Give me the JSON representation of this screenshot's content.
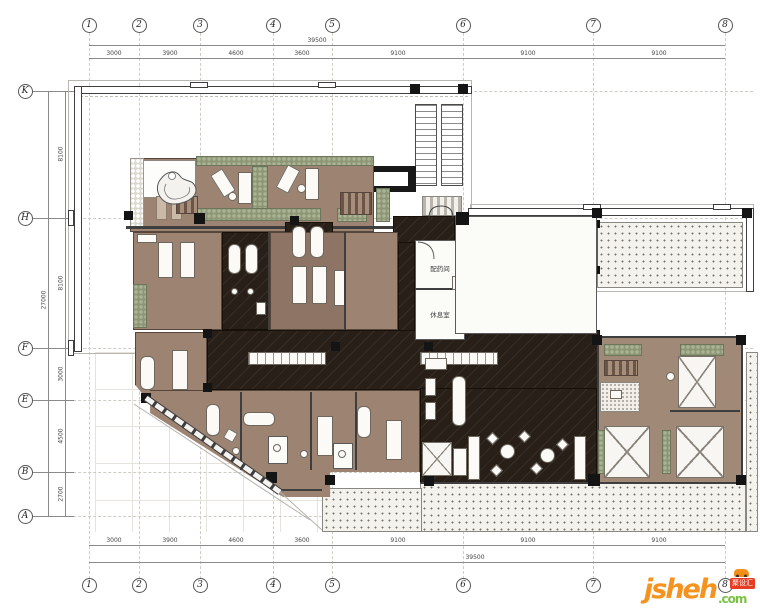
{
  "grid": {
    "top": [
      "1",
      "2",
      "3",
      "4",
      "5",
      "6",
      "7",
      "8"
    ],
    "bottom": [
      "1",
      "2",
      "3",
      "4",
      "5",
      "6",
      "7",
      "8"
    ],
    "left": [
      "K",
      "H",
      "F",
      "E",
      "B",
      "A"
    ]
  },
  "dimensions": {
    "top": {
      "overall": "39500",
      "segments": [
        "3000",
        "3900",
        "4600",
        "3600",
        "9100",
        "9100",
        "9100"
      ]
    },
    "bottom": {
      "overall": "39500",
      "segments": [
        "3000",
        "3900",
        "4600",
        "3600",
        "9100",
        "9100",
        "9100"
      ]
    },
    "left": {
      "overall": "27000",
      "segments": [
        "8100",
        "8100",
        "3000",
        "4500",
        "2700"
      ]
    }
  },
  "rooms": {
    "dispensary": "配药间",
    "rest_room": "休息室"
  },
  "watermark": {
    "brand": "jsheh",
    "tld": ".com",
    "badge": "聚设汇"
  },
  "colors": {
    "wood": "#9c8372",
    "dark_marble": "#271f18",
    "foliage": "#8e9678",
    "paving_dot": "#77736a",
    "watermark_orange": "#f6921e",
    "watermark_green": "#7ac143",
    "watermark_red": "#e63c22"
  }
}
